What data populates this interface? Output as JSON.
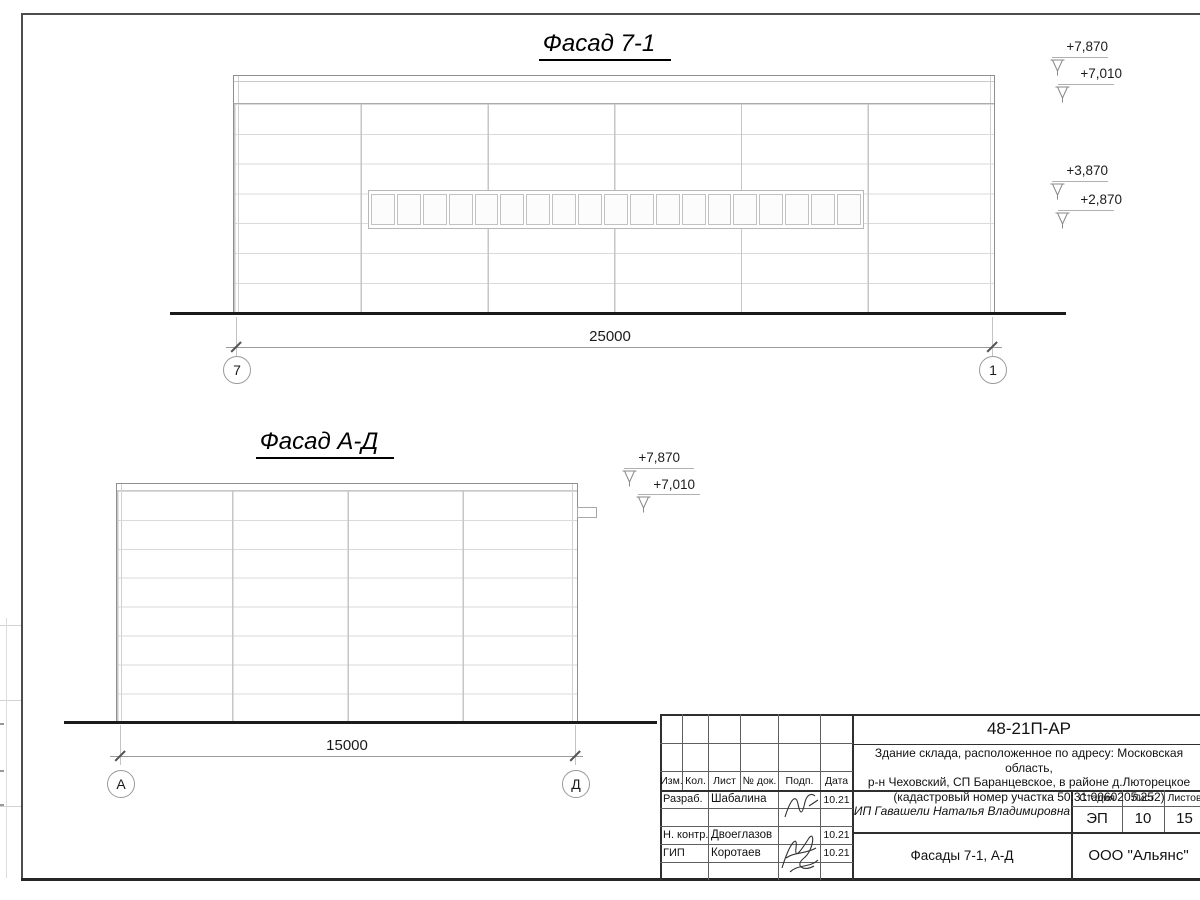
{
  "facade1": {
    "title": "Фасад 7-1",
    "dim": "25000",
    "axisL": "7",
    "axisR": "1",
    "elev": [
      "+7,870",
      "+7,010",
      "+3,870",
      "+2,870"
    ]
  },
  "facade2": {
    "title": "Фасад А-Д",
    "dim": "15000",
    "axisL": "А",
    "axisR": "Д",
    "elev": [
      "+7,870",
      "+7,010"
    ]
  },
  "stamp": {
    "doc": "48-21П-АР",
    "desc1": "Здание склада, расположенное по адресу: Московская область,",
    "desc2": "р-н Чеховский, СП Баранцевское, в районе д.Люторецкое",
    "desc3": "(кадастровый номер участка 50:31:0060205:252)",
    "col_izm": "Изм.",
    "col_kol": "Кол.",
    "col_list": "Лист",
    "col_ndok": "№ док.",
    "col_podp": "Подп.",
    "col_data": "Дата",
    "r1role": "Разраб.",
    "r1name": "Шабалина",
    "r1date": "10.21",
    "r3role": "Н. контр.",
    "r3name": "Двоеглазов",
    "r3date": "10.21",
    "r4role": "ГИП",
    "r4name": "Коротаев",
    "r4date": "10.21",
    "client": "ИП Гавашели Наталья Владимировна",
    "sheet_title": "Фасады 7-1, А-Д",
    "stage_label": "Стадия",
    "sheet_label": "Лист",
    "sheets_label": "Листов",
    "stage": "ЭП",
    "sheet": "10",
    "sheets": "15",
    "org": "ООО \"Альянс\""
  }
}
